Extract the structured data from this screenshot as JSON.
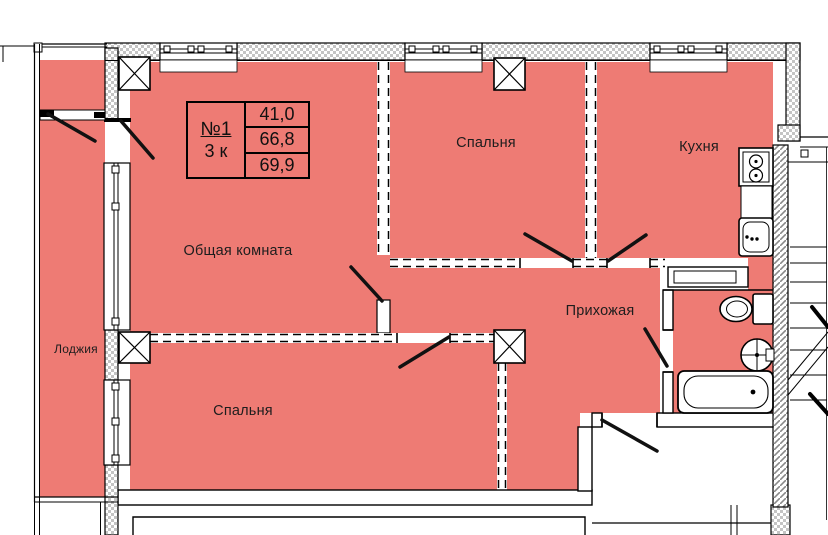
{
  "floorplan": {
    "info_box": {
      "apartment_number": "№1",
      "rooms_count": "3 к",
      "living_area": "41,0",
      "usable_area": "66,8",
      "total_area": "69,9"
    },
    "rooms": [
      {
        "key": "living-room",
        "label": "Общая комната"
      },
      {
        "key": "bedroom-top",
        "label": "Спальня"
      },
      {
        "key": "kitchen",
        "label": "Кухня"
      },
      {
        "key": "hallway",
        "label": "Прихожая"
      },
      {
        "key": "bedroom-bottom",
        "label": "Спальня"
      },
      {
        "key": "loggia",
        "label": "Лоджия"
      }
    ],
    "colors": {
      "room_fill": "#ee7b74",
      "wall_outline": "#000000",
      "hatch_gray": "#c4c4c4"
    }
  }
}
